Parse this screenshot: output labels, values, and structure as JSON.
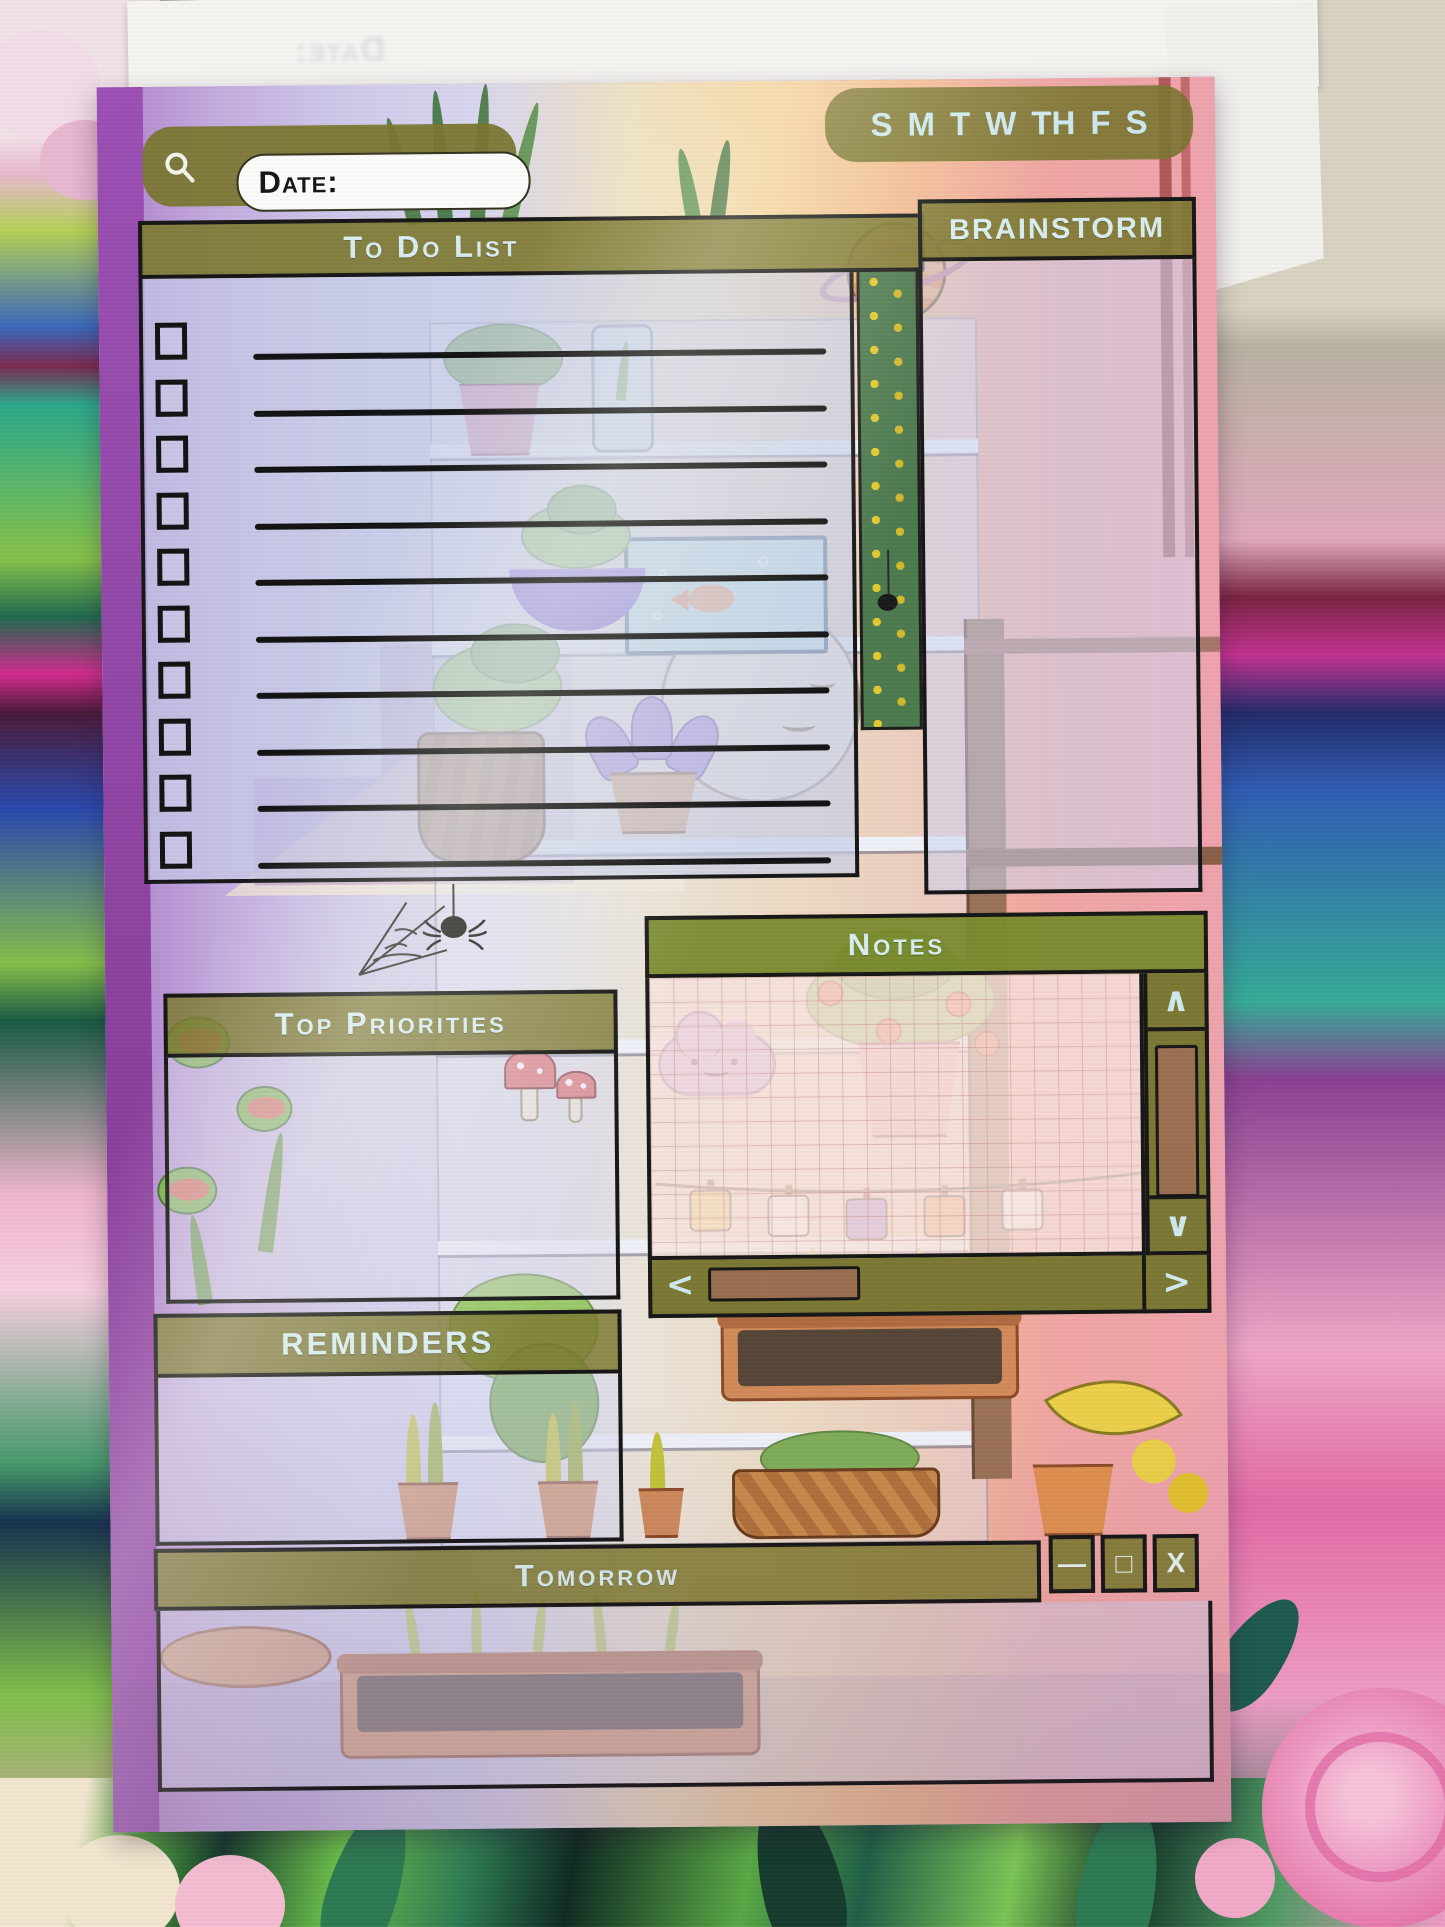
{
  "pad": {
    "ghost_text": "Date:"
  },
  "topbar": {
    "search_icon": "magnifier",
    "date_label": "Date:",
    "date_value": "",
    "weekdays": [
      "S",
      "M",
      "T",
      "W",
      "TH",
      "F",
      "S"
    ]
  },
  "panels": {
    "todo": {
      "title": "To Do List",
      "rows": 10
    },
    "brainstorm": {
      "title": "BRAINSTORM"
    },
    "top_priorities": {
      "title": "Top Priorities"
    },
    "reminders": {
      "title": "REMINDERS"
    },
    "notes": {
      "title": "Notes",
      "scrollbar": {
        "up": "∧",
        "down": "∨",
        "left": "<",
        "right": ">"
      }
    },
    "tomorrow": {
      "title": "Tomorrow"
    }
  },
  "window_controls": {
    "minimize": "—",
    "maximize": "□",
    "close": "X"
  },
  "colors": {
    "olive": "#7b7833",
    "notes_green": "#7a8a2e",
    "light_blue_text": "#cdeaf0",
    "ink": "#161616",
    "scroll_thumb_brown": "#9b6f50",
    "page_purple": "#9b50b4",
    "page_peach": "#f6d49e",
    "page_pink": "#efa3ad"
  }
}
